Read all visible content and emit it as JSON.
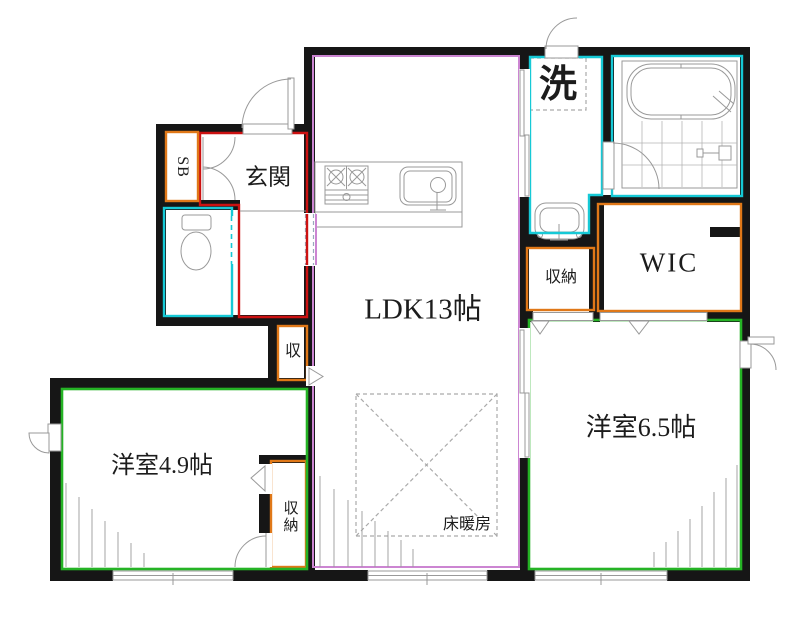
{
  "title": "間取り図",
  "labels": {
    "genkan": "玄関",
    "shoe_box": "SB",
    "laundry": "洗",
    "hall_storage": "収納",
    "wic": "WIC",
    "ldk": "LDK13帖",
    "shu": "収",
    "room49": "洋室4.9帖",
    "bedroom_closet": "収納",
    "room65": "洋室6.5帖",
    "floor_heating": "床暖房"
  },
  "colors": {
    "wall": "#161616",
    "entrance": "#cc1111",
    "water": "#16c9d6",
    "storage": "#e07818",
    "bedroom": "#25b325",
    "ldk": "#cc85d2"
  }
}
